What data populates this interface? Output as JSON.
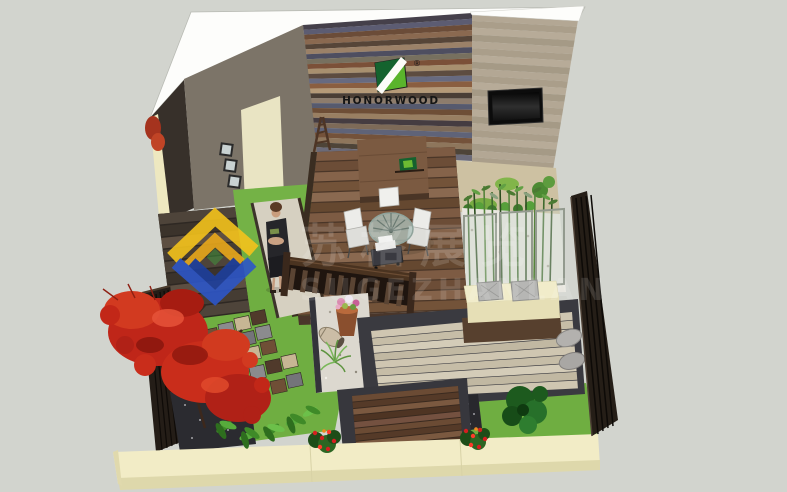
{
  "scene_title": "3D courtyard garden rendering (SketchUp style)",
  "logo": {
    "name": "HONORWOOD",
    "registered": "®",
    "emblem_dark_green": "#14632e",
    "emblem_light_green": "#5ab42c",
    "text_color": "#151515"
  },
  "watermark": {
    "text_cn": "苏格展览",
    "text_latin": "SUGEZHANLAN",
    "diamond_colors": [
      "#f4c31c",
      "#e9a81b",
      "#2d56c8",
      "#1d3f9d"
    ],
    "text_color": "#ffffff"
  },
  "palette": {
    "background": "#d2d4ce",
    "white_wall": "#fdfdfb",
    "taupe_wall": "#7c7468",
    "door_cream": "#e9e4c3",
    "curb_cream": "#f2ecc6",
    "grass_green": "#6fae41",
    "sand_tan": "#cdc1a2",
    "moss_green": "#82b54a",
    "deck_brown": "#7d5b43",
    "platform_brown": "#6b4b34",
    "fence_dark": "#241d17",
    "maple_red": "#c0261a",
    "white_gravel": "#e9e7e0",
    "dark_gravel": "#2b2b30",
    "glass_panel_frame": "#939a8e",
    "tv_black": "#0c0c0c",
    "cushion_gray": "#b6b6b4"
  },
  "textures": {
    "feature_wall": {
      "L": [
        [
          303,
          25
        ],
        [
          317,
          152
        ]
      ],
      "R": [
        [
          472,
          13
        ],
        [
          472,
          161
        ]
      ],
      "n": 26,
      "gap": 0,
      "colors": [
        "#45404a",
        "#5c5c72",
        "#6b4c38",
        "#8a6950",
        "#564538",
        "#9b8168",
        "#4e4e60",
        "#77705f",
        "#7b5038",
        "#a8906f",
        "#5d4c40",
        "#676a80",
        "#8a5e40",
        "#b59a78",
        "#4a3e35",
        "#8d7c6c",
        "#565a6e",
        "#6e4e36",
        "#997f62",
        "#453c41",
        "#7d6a58",
        "#5f6378",
        "#74523a",
        "#8e765c",
        "#4e4438",
        "#6b6a78"
      ]
    },
    "tan_wall": {
      "L": [
        [
          472,
          14
        ],
        [
          472,
          164
        ]
      ],
      "R": [
        [
          578,
          20
        ],
        [
          553,
          170
        ]
      ],
      "n": 22,
      "gap": 0,
      "colors": [
        "#b3a794",
        "#aa9e8a",
        "#b7ab98",
        "#a59a86"
      ]
    },
    "dining_deck": {
      "L": [
        [
          317,
          152
        ],
        [
          298,
          316
        ]
      ],
      "R": [
        [
          455,
          147
        ],
        [
          468,
          310
        ]
      ],
      "n": 16,
      "gap": 0.12,
      "colors": [
        "#7d5b43",
        "#6c4d37",
        "#85634a",
        "#735339",
        "#8a6950",
        "#654830"
      ]
    },
    "steps_inner": {
      "L": [
        [
          352,
          396
        ],
        [
          358,
          468
        ]
      ],
      "R": [
        [
          458,
          386
        ],
        [
          464,
          456
        ]
      ],
      "n": 11,
      "gap": 0.15,
      "colors": [
        "#6b4b34",
        "#553a28",
        "#7b5940",
        "#4e3423",
        "#745140"
      ]
    },
    "left_deck": {
      "L": [
        [
          158,
          214
        ],
        [
          172,
          322
        ]
      ],
      "R": [
        [
          235,
          207
        ],
        [
          250,
          312
        ]
      ],
      "n": 9,
      "gap": 0.12,
      "colors": [
        "#4e443a",
        "#3b332b",
        "#5d4f42",
        "#453c33"
      ]
    },
    "tan_deck": {
      "L": [
        [
          371,
          331
        ],
        [
          380,
          399
        ]
      ],
      "R": [
        [
          572,
          312
        ],
        [
          578,
          389
        ]
      ],
      "n": 9,
      "gap": 0.08,
      "colors": [
        "#cfc6b1",
        "#c6bda7",
        "#d4ccb8",
        "#c1b8a2"
      ]
    }
  }
}
